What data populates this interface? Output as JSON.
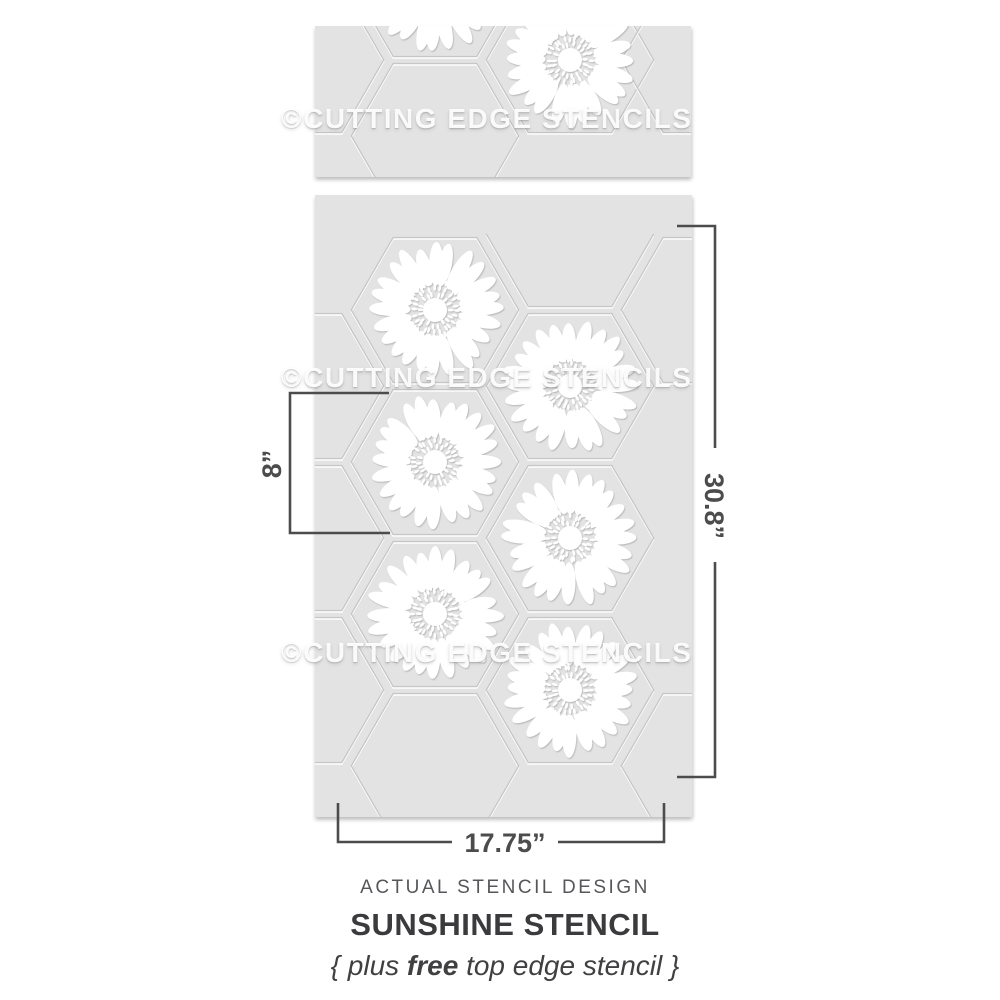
{
  "watermark": {
    "text": "©CUTTING EDGE STENCILS"
  },
  "dimensions": {
    "hexagon_height_label": "8”",
    "sheet_height_label": "30.8”",
    "sheet_width_label": "17.75”"
  },
  "caption": {
    "eyebrow": "ACTUAL STENCIL DESIGN",
    "title": "SUNSHINE STENCIL",
    "note_prefix": "{ plus ",
    "note_bold": "free",
    "note_suffix": " top edge stencil }"
  },
  "colors": {
    "background": "#ffffff",
    "sheet": "#e3e3e3",
    "cut_line": "#c6c6c6",
    "cut_highlight": "#ffffff",
    "cutout": "#ffffff",
    "dimension_line": "#4c4c4c",
    "text_dark": "#3b3b3d",
    "text_medium": "#56575a"
  },
  "stencil": {
    "hex_radius": 90,
    "hex_shrink": 0.93,
    "petals_per_flower": 24,
    "sheets": [
      {
        "label": "top edge stencil",
        "x": 315,
        "y": 26,
        "w": 376,
        "h": 151,
        "hexes": [
          [
            300,
            60,
            0
          ],
          [
            435,
            -16,
            1
          ],
          [
            435,
            136,
            0
          ],
          [
            570,
            60,
            1
          ],
          [
            705,
            60,
            0
          ]
        ]
      },
      {
        "label": "sunshine stencil",
        "x": 315,
        "y": 195,
        "w": 377,
        "h": 622,
        "hexes": [
          [
            300,
            386,
            0
          ],
          [
            300,
            538,
            0
          ],
          [
            300,
            690,
            0
          ],
          [
            435,
            310,
            1
          ],
          [
            435,
            462,
            1
          ],
          [
            435,
            614,
            1
          ],
          [
            435,
            766,
            0
          ],
          [
            570,
            234,
            2
          ],
          [
            570,
            386,
            1
          ],
          [
            570,
            538,
            1
          ],
          [
            570,
            690,
            1
          ],
          [
            705,
            310,
            0
          ],
          [
            705,
            766,
            0
          ]
        ]
      }
    ]
  }
}
